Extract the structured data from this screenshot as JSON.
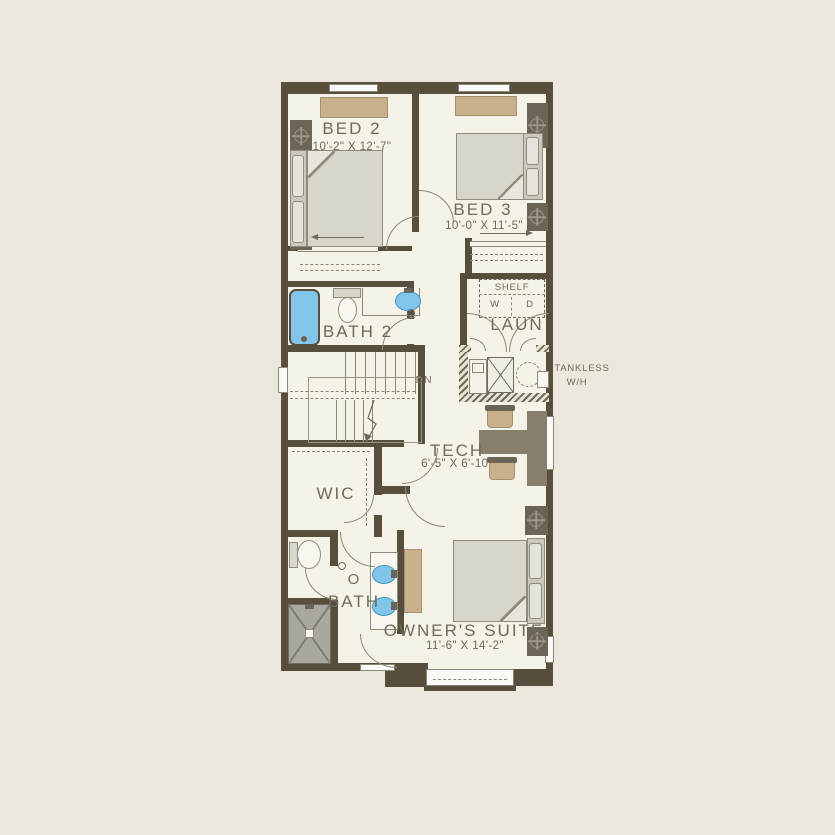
{
  "plan": {
    "rooms": {
      "bed2": {
        "label": "BED 2",
        "dims": "10'-2\" X 12'-7\""
      },
      "bed3": {
        "label": "BED 3",
        "dims": "10'-0\" X 11'-5\""
      },
      "bath2": {
        "label": "BATH 2"
      },
      "laundry": {
        "label": "LAUN",
        "shelf": "SHELF",
        "washer": "W",
        "dryer": "D"
      },
      "tech": {
        "label": "TECH",
        "dims": "6'-5\" X 6'-10\""
      },
      "wic": {
        "label": "WIC"
      },
      "owners_bath": {
        "prefix": "O",
        "label": "BATH"
      },
      "owners_suite": {
        "label": "OWNER'S SUITE",
        "dims": "11'-6\" X 14'-2\""
      }
    },
    "annotations": {
      "stairs_down": "DN",
      "tankless_line1": "TANKLESS",
      "tankless_line2": "W/H"
    },
    "colors": {
      "background": "#ECE8DE",
      "floor": "#F5F2E8",
      "wall": "#564F3E",
      "fixture_blue": "#82C5EA",
      "furniture_tan": "#C9B08C",
      "furniture_gray": "#D8D5CB",
      "text": "#6F6A5B"
    }
  }
}
